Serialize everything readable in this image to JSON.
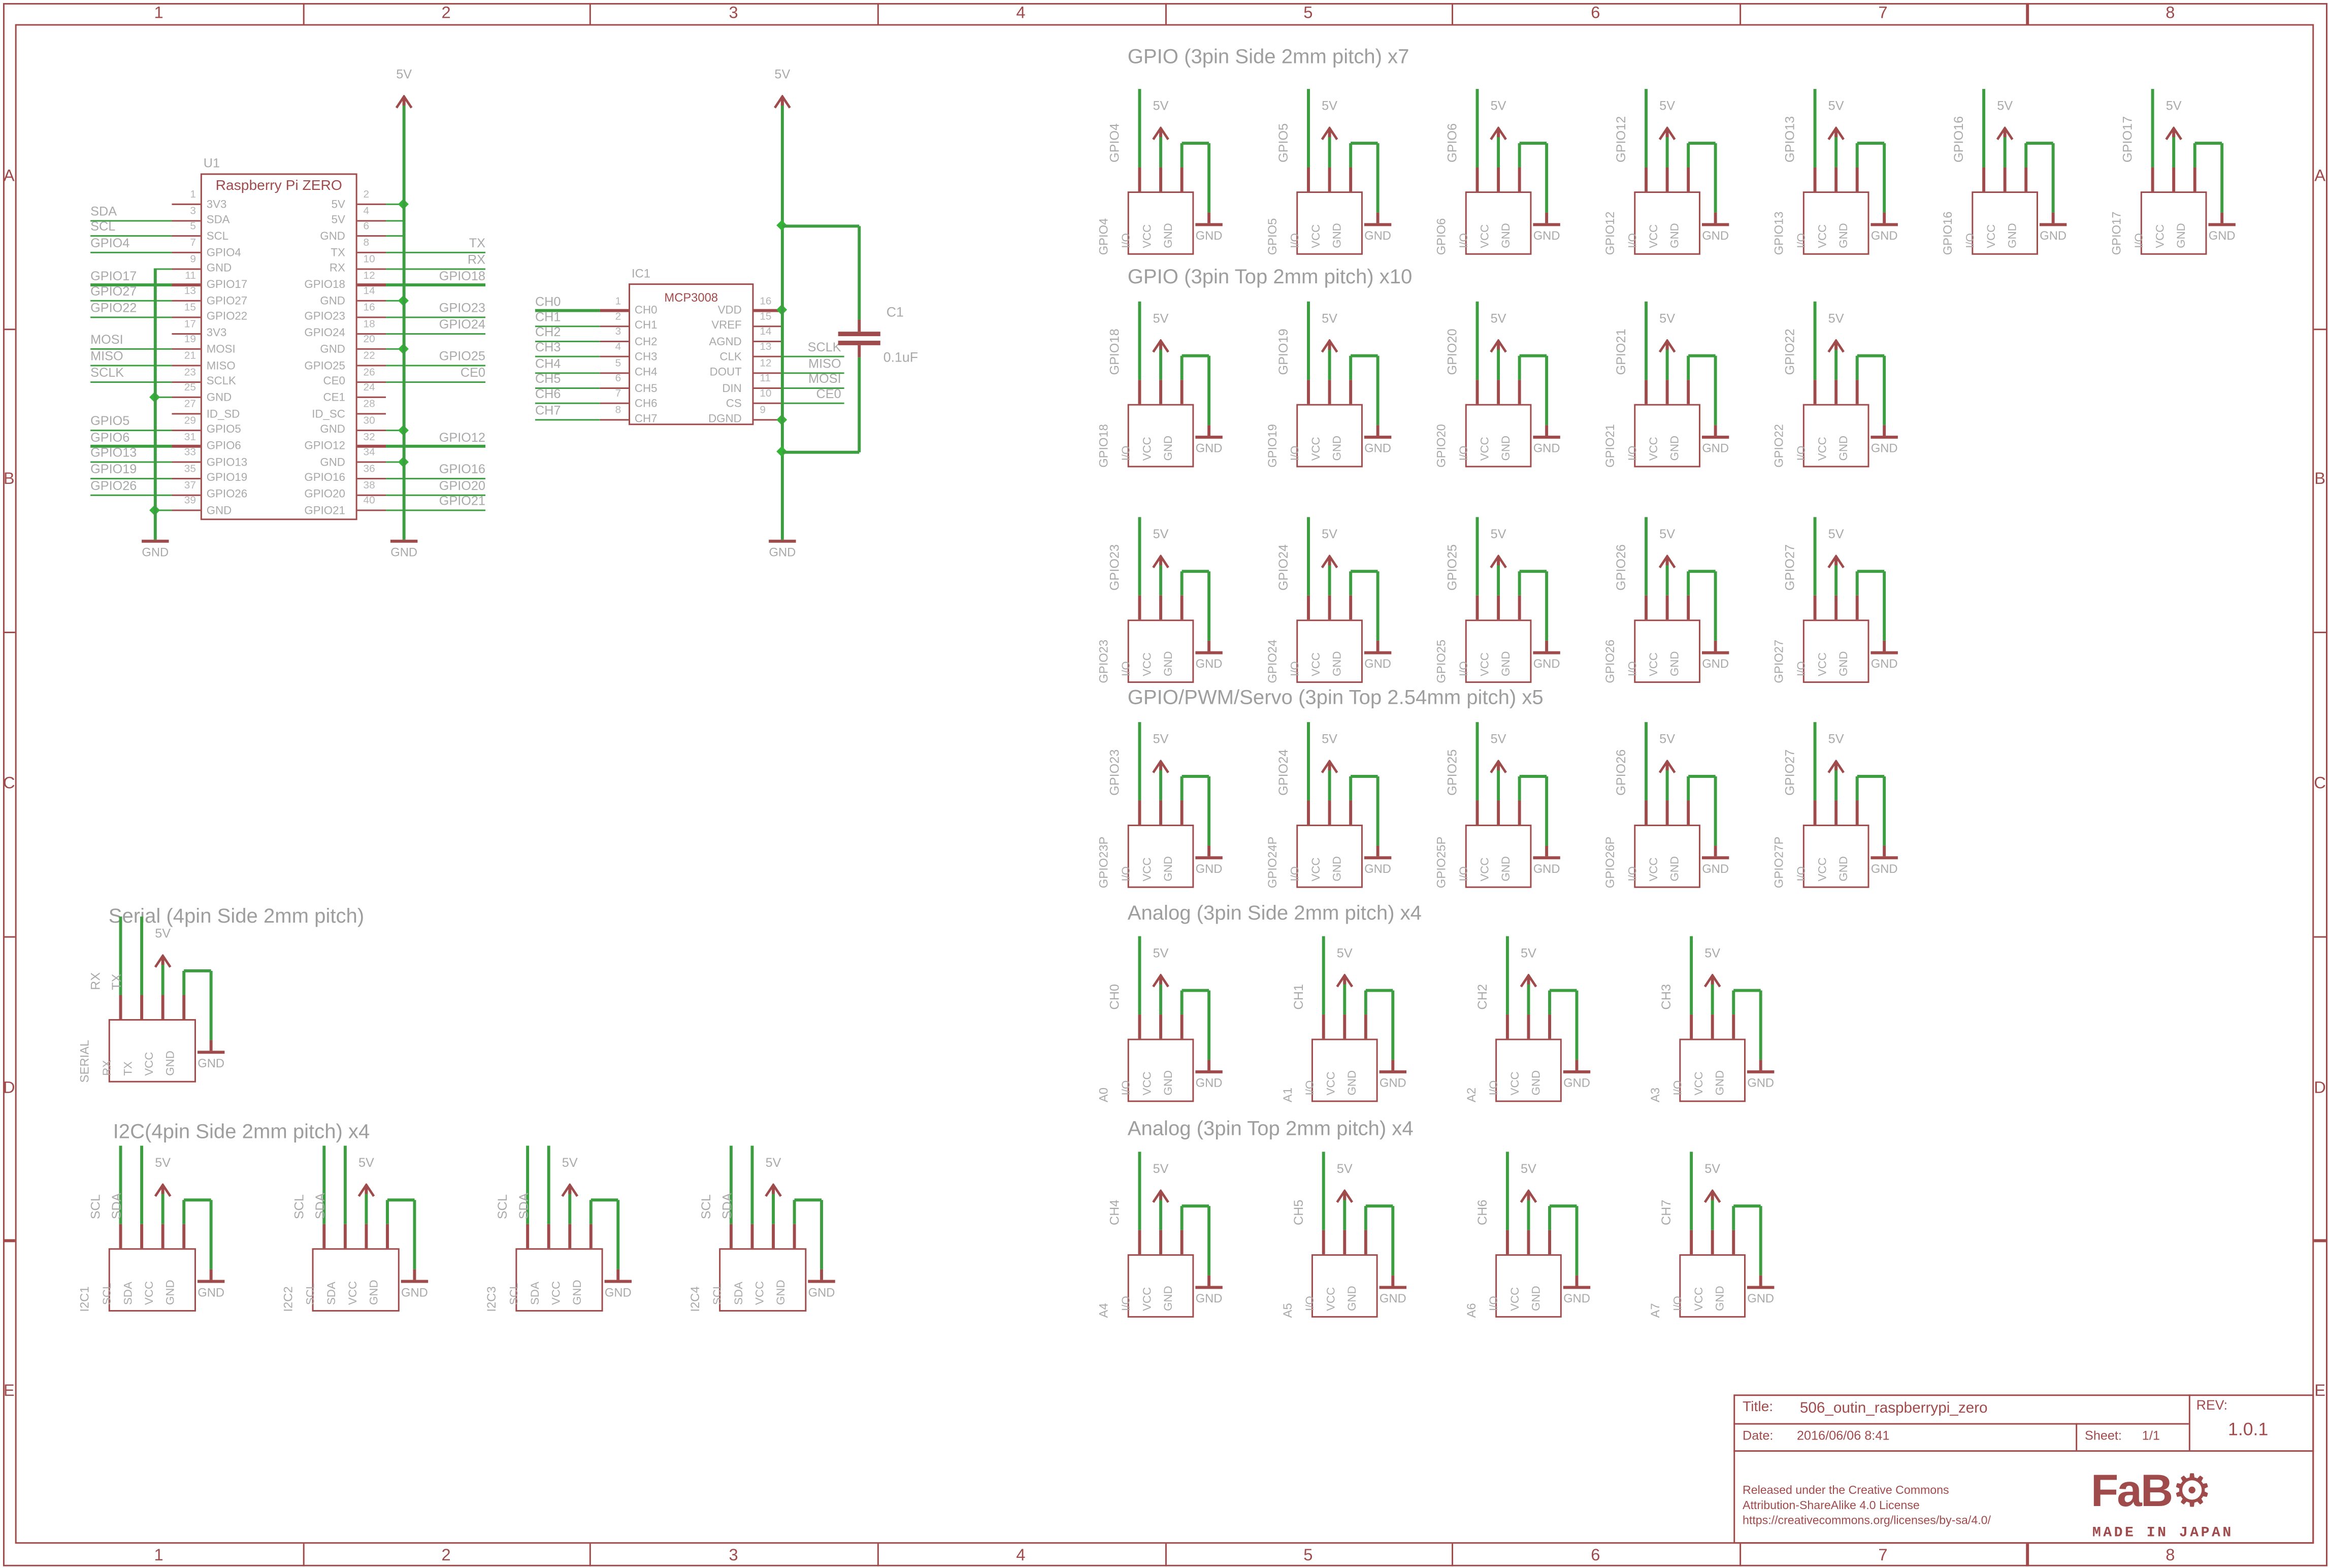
{
  "colors": {
    "red": "#a04b4b",
    "green": "#3c9e40",
    "junction": "#35b336",
    "gray": "#a9a9a9",
    "gray_light": "#b5b5b5"
  },
  "power": {
    "v5": "5V",
    "gnd": "GND"
  },
  "frame": {
    "columns": [
      "1",
      "2",
      "3",
      "4",
      "5",
      "6",
      "7",
      "8"
    ],
    "rows": [
      "A",
      "B",
      "C",
      "D",
      "E"
    ]
  },
  "title_block": {
    "title_label": "Title:",
    "title": "506_outin_raspberrypi_zero",
    "date_label": "Date:",
    "date": "2016/06/06 8:41",
    "sheet_label": "Sheet:",
    "sheet": "1/1",
    "rev_label": "REV:",
    "rev": "1.0.1",
    "license_lines": [
      "Released under the Creative Commons",
      "Attribution-ShareAlike 4.0 License",
      "https://creativecommons.org/licenses/by-sa/4.0/"
    ],
    "logo_text": "FaB",
    "logo_gear": "⚙",
    "logo_sub": "MADE IN JAPAN"
  },
  "u1": {
    "ref": "U1",
    "name": "Raspberry Pi ZERO",
    "left_pins": [
      {
        "n": "1",
        "p": "3V3",
        "conn": ""
      },
      {
        "n": "3",
        "p": "SDA",
        "conn": "net",
        "net": "SDA"
      },
      {
        "n": "5",
        "p": "SCL",
        "conn": "net",
        "net": "SCL"
      },
      {
        "n": "7",
        "p": "GPIO4",
        "conn": "net",
        "net": "GPIO4"
      },
      {
        "n": "9",
        "p": "GND",
        "conn": "pwr"
      },
      {
        "n": "11",
        "p": "GPIO17",
        "conn": "net",
        "net": "GPIO17"
      },
      {
        "n": "13",
        "p": "GPIO27",
        "conn": "net",
        "net": "GPIO27"
      },
      {
        "n": "15",
        "p": "GPIO22",
        "conn": "net",
        "net": "GPIO22"
      },
      {
        "n": "17",
        "p": "3V3",
        "conn": ""
      },
      {
        "n": "19",
        "p": "MOSI",
        "conn": "net",
        "net": "MOSI"
      },
      {
        "n": "21",
        "p": "MISO",
        "conn": "net",
        "net": "MISO"
      },
      {
        "n": "23",
        "p": "SCLK",
        "conn": "net",
        "net": "SCLK"
      },
      {
        "n": "25",
        "p": "GND",
        "conn": "pwr",
        "dot": true
      },
      {
        "n": "27",
        "p": "ID_SD",
        "conn": ""
      },
      {
        "n": "29",
        "p": "GPIO5",
        "conn": "net",
        "net": "GPIO5"
      },
      {
        "n": "31",
        "p": "GPIO6",
        "conn": "net",
        "net": "GPIO6"
      },
      {
        "n": "33",
        "p": "GPIO13",
        "conn": "net",
        "net": "GPIO13"
      },
      {
        "n": "35",
        "p": "GPIO19",
        "conn": "net",
        "net": "GPIO19"
      },
      {
        "n": "37",
        "p": "GPIO26",
        "conn": "net",
        "net": "GPIO26"
      },
      {
        "n": "39",
        "p": "GND",
        "conn": "pwr",
        "dot": true
      }
    ],
    "right_pins": [
      {
        "n": "2",
        "p": "5V",
        "conn": "pwr",
        "dot": true
      },
      {
        "n": "4",
        "p": "5V",
        "conn": "pwr"
      },
      {
        "n": "6",
        "p": "GND",
        "conn": "pwr"
      },
      {
        "n": "8",
        "p": "TX",
        "conn": "net",
        "net": "TX"
      },
      {
        "n": "10",
        "p": "RX",
        "conn": "net",
        "net": "RX"
      },
      {
        "n": "12",
        "p": "GPIO18",
        "conn": "net",
        "net": "GPIO18"
      },
      {
        "n": "14",
        "p": "GND",
        "conn": "pwr",
        "dot": true
      },
      {
        "n": "16",
        "p": "GPIO23",
        "conn": "net",
        "net": "GPIO23"
      },
      {
        "n": "18",
        "p": "GPIO24",
        "conn": "net",
        "net": "GPIO24"
      },
      {
        "n": "20",
        "p": "GND",
        "conn": "pwr",
        "dot": true
      },
      {
        "n": "22",
        "p": "GPIO25",
        "conn": "net",
        "net": "GPIO25"
      },
      {
        "n": "26",
        "p": "CE0",
        "conn": "net",
        "net": "CE0"
      },
      {
        "n": "24",
        "p": "CE1",
        "conn": ""
      },
      {
        "n": "28",
        "p": "ID_SC",
        "conn": ""
      },
      {
        "n": "30",
        "p": "GND",
        "conn": "pwr",
        "dot": true
      },
      {
        "n": "32",
        "p": "GPIO12",
        "conn": "net",
        "net": "GPIO12"
      },
      {
        "n": "34",
        "p": "GND",
        "conn": "pwr",
        "dot": true
      },
      {
        "n": "36",
        "p": "GPIO16",
        "conn": "net",
        "net": "GPIO16"
      },
      {
        "n": "38",
        "p": "GPIO20",
        "conn": "net",
        "net": "GPIO20"
      },
      {
        "n": "40",
        "p": "GPIO21",
        "conn": "net",
        "net": "GPIO21"
      }
    ]
  },
  "ic1": {
    "ref": "IC1",
    "name": "MCP3008",
    "left_pins": [
      {
        "n": "1",
        "p": "CH0",
        "conn": "net",
        "net": "CH0"
      },
      {
        "n": "2",
        "p": "CH1",
        "conn": "net",
        "net": "CH1"
      },
      {
        "n": "3",
        "p": "CH2",
        "conn": "net",
        "net": "CH2"
      },
      {
        "n": "4",
        "p": "CH3",
        "conn": "net",
        "net": "CH3"
      },
      {
        "n": "5",
        "p": "CH4",
        "conn": "net",
        "net": "CH4"
      },
      {
        "n": "6",
        "p": "CH5",
        "conn": "net",
        "net": "CH5"
      },
      {
        "n": "7",
        "p": "CH6",
        "conn": "net",
        "net": "CH6"
      },
      {
        "n": "8",
        "p": "CH7",
        "conn": "net",
        "net": "CH7"
      }
    ],
    "right_pins": [
      {
        "n": "16",
        "p": "VDD",
        "conn": "pwr",
        "dot": true
      },
      {
        "n": "15",
        "p": "VREF",
        "conn": "pwr"
      },
      {
        "n": "14",
        "p": "AGND",
        "conn": "pwr"
      },
      {
        "n": "13",
        "p": "CLK",
        "conn": "net",
        "net": "SCLK"
      },
      {
        "n": "12",
        "p": "DOUT",
        "conn": "net",
        "net": "MISO"
      },
      {
        "n": "11",
        "p": "DIN",
        "conn": "net",
        "net": "MOSI"
      },
      {
        "n": "10",
        "p": "CS",
        "conn": "net",
        "net": "CE0"
      },
      {
        "n": "9",
        "p": "DGND",
        "conn": "pwr",
        "dot": true
      }
    ]
  },
  "c1": {
    "ref": "C1",
    "value": "0.1uF"
  },
  "connector_pins_3": [
    "I/O",
    "VCC",
    "GND"
  ],
  "serial": {
    "title": "Serial (4pin Side 2mm pitch)",
    "name": "SERIAL",
    "pins": [
      "RX",
      "TX",
      "VCC",
      "GND"
    ],
    "wire_labels": [
      "RX",
      "TX"
    ]
  },
  "i2c": {
    "title": "I2C(4pin Side 2mm pitch) x4",
    "names": [
      "I2C1",
      "I2C2",
      "I2C3",
      "I2C4"
    ],
    "pins": [
      "SCL",
      "SDA",
      "VCC",
      "GND"
    ],
    "wire_labels": [
      "SCL",
      "SDA"
    ]
  },
  "groups": [
    {
      "title": "GPIO (3pin Side 2mm pitch) x7",
      "rows": [
        [
          {
            "label": "GPIO4",
            "name": "GPIO4"
          },
          {
            "label": "GPIO5",
            "name": "GPIO5"
          },
          {
            "label": "GPIO6",
            "name": "GPIO6"
          },
          {
            "label": "GPIO12",
            "name": "GPIO12"
          },
          {
            "label": "GPIO13",
            "name": "GPIO13"
          },
          {
            "label": "GPIO16",
            "name": "GPIO16"
          },
          {
            "label": "GPIO17",
            "name": "GPIO17"
          }
        ]
      ]
    },
    {
      "title": "GPIO (3pin Top 2mm pitch) x10",
      "rows": [
        [
          {
            "label": "GPIO18",
            "name": "GPIO18"
          },
          {
            "label": "GPIO19",
            "name": "GPIO19"
          },
          {
            "label": "GPIO20",
            "name": "GPIO20"
          },
          {
            "label": "GPIO21",
            "name": "GPIO21"
          },
          {
            "label": "GPIO22",
            "name": "GPIO22"
          }
        ],
        [
          {
            "label": "GPIO23",
            "name": "GPIO23"
          },
          {
            "label": "GPIO24",
            "name": "GPIO24"
          },
          {
            "label": "GPIO25",
            "name": "GPIO25"
          },
          {
            "label": "GPIO26",
            "name": "GPIO26"
          },
          {
            "label": "GPIO27",
            "name": "GPIO27"
          }
        ]
      ]
    },
    {
      "title": "GPIO/PWM/Servo (3pin Top 2.54mm pitch) x5",
      "rows": [
        [
          {
            "label": "GPIO23",
            "name": "GPIO23P"
          },
          {
            "label": "GPIO24",
            "name": "GPIO24P"
          },
          {
            "label": "GPIO25",
            "name": "GPIO25P"
          },
          {
            "label": "GPIO26",
            "name": "GPIO26P"
          },
          {
            "label": "GPIO27",
            "name": "GPIO27P"
          }
        ]
      ]
    },
    {
      "title": "Analog (3pin Side 2mm pitch) x4",
      "rows": [
        [
          {
            "label": "CH0",
            "name": "A0"
          },
          {
            "label": "CH1",
            "name": "A1"
          },
          {
            "label": "CH2",
            "name": "A2"
          },
          {
            "label": "CH3",
            "name": "A3"
          }
        ]
      ]
    },
    {
      "title": "Analog (3pin Top 2mm pitch) x4",
      "rows": [
        [
          {
            "label": "CH4",
            "name": "A4"
          },
          {
            "label": "CH5",
            "name": "A5"
          },
          {
            "label": "CH6",
            "name": "A6"
          },
          {
            "label": "CH7",
            "name": "A7"
          }
        ]
      ]
    }
  ]
}
